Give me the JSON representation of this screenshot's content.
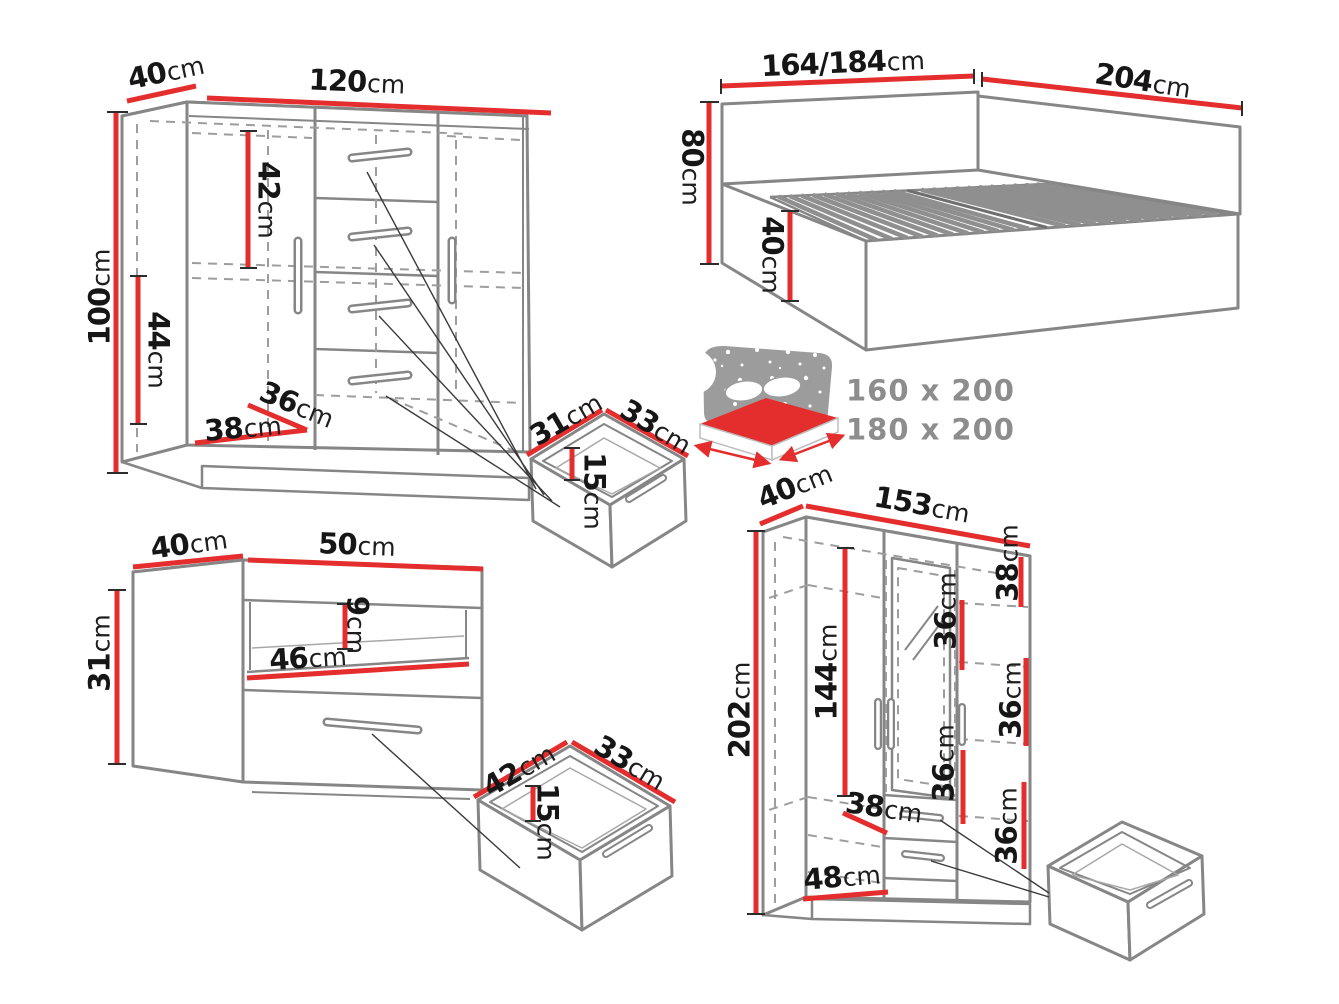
{
  "commode": {
    "depth": {
      "v": "40",
      "u": "cm"
    },
    "width": {
      "v": "120",
      "u": "cm"
    },
    "height": {
      "v": "100",
      "u": "cm"
    },
    "upper_section": {
      "v": "42",
      "u": "cm"
    },
    "lower_section": {
      "v": "44",
      "u": "cm"
    },
    "inner_depth": {
      "v": "36",
      "u": "cm"
    },
    "inner_width": {
      "v": "38",
      "u": "cm"
    }
  },
  "bed": {
    "width": {
      "v": "164/184",
      "u": "cm"
    },
    "length": {
      "v": "204",
      "u": "cm"
    },
    "headboard_height": {
      "v": "80",
      "u": "cm"
    },
    "base_height": {
      "v": "40",
      "u": "cm"
    },
    "mattress_sizes": [
      "160 x 200",
      "180 x 200"
    ]
  },
  "small_drawer_top": {
    "depth": {
      "v": "31",
      "u": "cm"
    },
    "width": {
      "v": "33",
      "u": "cm"
    },
    "height": {
      "v": "15",
      "u": "cm"
    }
  },
  "nightstand": {
    "depth": {
      "v": "40",
      "u": "cm"
    },
    "width": {
      "v": "50",
      "u": "cm"
    },
    "height": {
      "v": "31",
      "u": "cm"
    },
    "inner_width": {
      "v": "46",
      "u": "cm"
    },
    "niche_height": {
      "v": "9",
      "u": "cm"
    }
  },
  "small_drawer_bottom": {
    "depth": {
      "v": "42",
      "u": "cm"
    },
    "width": {
      "v": "33",
      "u": "cm"
    },
    "height": {
      "v": "15",
      "u": "cm"
    }
  },
  "wardrobe": {
    "depth": {
      "v": "40",
      "u": "cm"
    },
    "width": {
      "v": "153",
      "u": "cm"
    },
    "height": {
      "v": "202",
      "u": "cm"
    },
    "hanging_height": {
      "v": "144",
      "u": "cm"
    },
    "left_inner_width": {
      "v": "38",
      "u": "cm"
    },
    "bottom_inner_width": {
      "v": "48",
      "u": "cm"
    },
    "right_top": {
      "v": "38",
      "u": "cm"
    },
    "middle_upper": {
      "v": "36",
      "u": "cm"
    },
    "middle_lower": {
      "v": "36",
      "u": "cm"
    },
    "right_middle": {
      "v": "36",
      "u": "cm"
    },
    "right_lower": {
      "v": "36",
      "u": "cm"
    }
  },
  "colors": {
    "dimension_red": "#e42e2e",
    "outline_gray": "#868686",
    "text_black": "#161616",
    "muted_gray": "#8d8d8d"
  }
}
